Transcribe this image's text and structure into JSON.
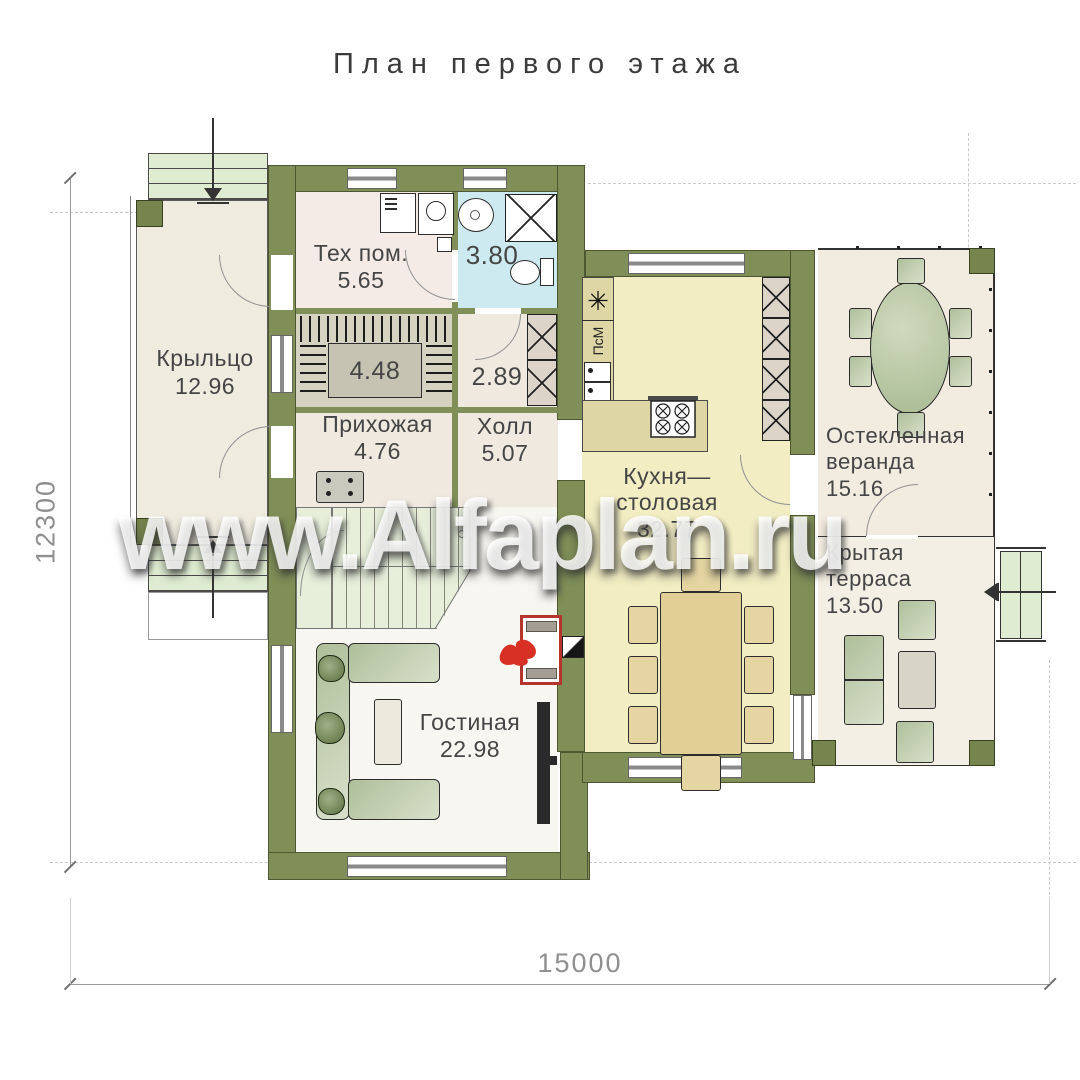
{
  "title": "План первого этажа",
  "watermark": "www.Alfaplan.ru",
  "dimensions": {
    "width_mm": "15000",
    "height_mm": "12300"
  },
  "rooms": {
    "porch": {
      "name": "Крыльцо",
      "area": "12.96"
    },
    "tech": {
      "name": "Тех пом.",
      "area": "5.65"
    },
    "bathroom": {
      "area": "3.80"
    },
    "wardrobe": {
      "area": "4.48"
    },
    "closet": {
      "area": "2.89"
    },
    "entry_hall": {
      "name": "Прихожая",
      "area": "4.76"
    },
    "hall": {
      "name": "Холл",
      "area": "5.07"
    },
    "kitchen_dining": {
      "name_line1": "Кухня—",
      "name_line2": "столовая",
      "area": "32.77"
    },
    "glazed_veranda": {
      "name_line1": "Остекленная",
      "name_line2": "веранда",
      "area": "15.16"
    },
    "covered_terrace": {
      "name_line1": "Крытая",
      "name_line2": "терраса",
      "area": "13.50"
    },
    "living_room": {
      "name": "Гостиная",
      "area": "22.98"
    }
  },
  "appliance_labels": {
    "dishwasher": "ПсМ",
    "freezer_symbol": "✳"
  },
  "colors": {
    "wall": "#7f8f57",
    "kitchen_floor": "#f2edc3",
    "bathroom_floor": "#cdeaf0",
    "steps": "#dfecd1",
    "fireplace_accent": "#b5342c",
    "furniture_green": "#b9c8a4"
  }
}
